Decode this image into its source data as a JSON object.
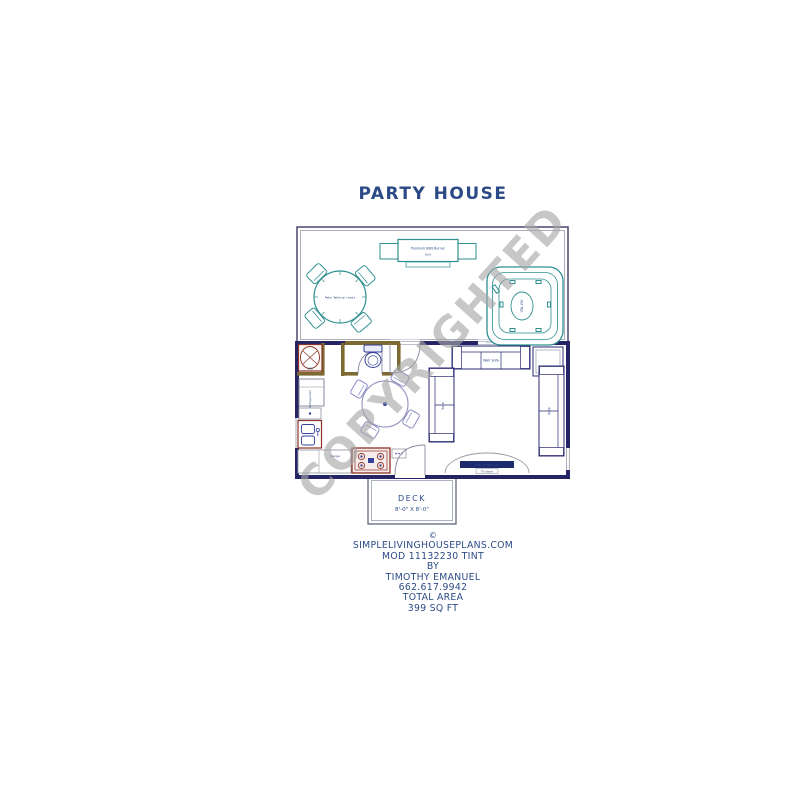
{
  "title": "PARTY HOUSE",
  "watermark": "COPYRIGHTED",
  "colors": {
    "ink": "#2b4a86",
    "wall": "#252565",
    "patio_furniture_teal": "#2e8f8f",
    "appliance_red": "#8a3326",
    "furniture_purple": "#8585c5",
    "bath_wall_tan": "#7d6a33",
    "watermark_gray": "#a6a6a6"
  },
  "labels": {
    "grill": "Premium BBQ Burner",
    "grill_sub": "Grill",
    "patio_table": "Patio Table w/ chairs",
    "hot_tub": "Hot Tub",
    "refrigerator": "Refrigerator",
    "range": "Range",
    "washer": "W/D",
    "sofa_wall": "Wall Sofa",
    "sofa_left": "Sofa",
    "sofa_right": "Sofa",
    "tv": "Flat Screen TV",
    "tv_stand": "TV stand"
  },
  "deck": {
    "label": "DECK",
    "size": "8'-0\" X 8'-0\""
  },
  "footer": {
    "lines": [
      "©",
      "SIMPLELIVINGHOUSEPLANS.COM",
      "MOD 11132230 TINT",
      "BY",
      "TIMOTHY EMANUEL",
      "662.617.9942",
      "TOTAL AREA",
      "399 SQ FT"
    ]
  }
}
